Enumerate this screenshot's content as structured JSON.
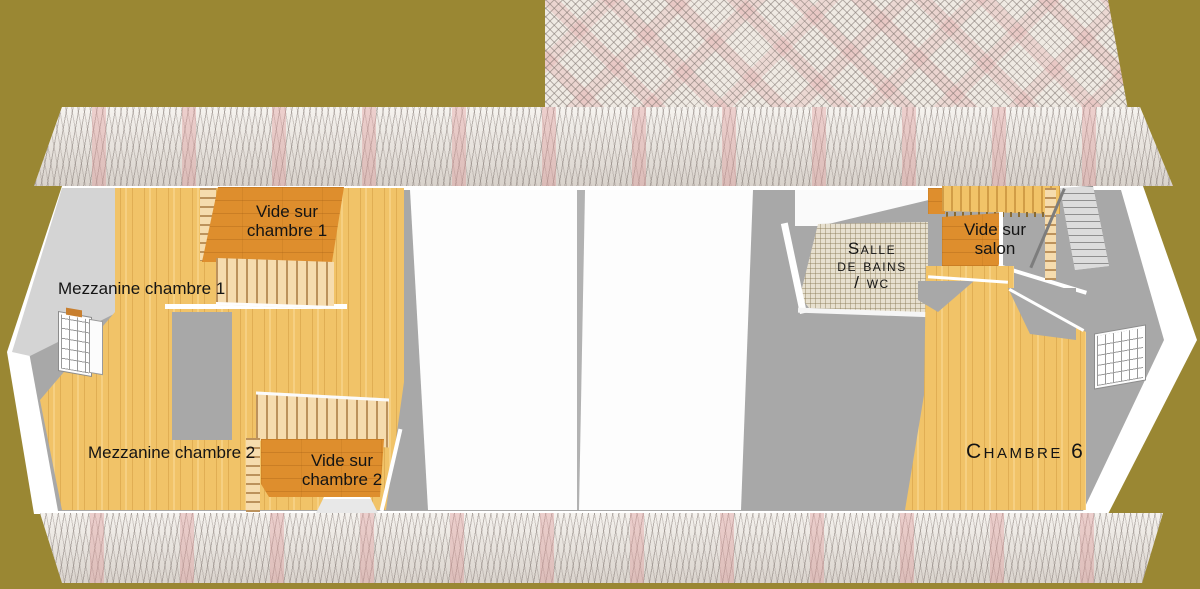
{
  "colors": {
    "background": "#9a8733",
    "roof_base": "#efeae3",
    "roof_pink": "#eec5c5",
    "wood_floor": "#f1c368",
    "wood_void": "#de8e2d",
    "wall_white": "#ffffff",
    "floor_gray": "#a8a8a8",
    "bath_tile": "#e7e0cf"
  },
  "rooms": [
    {
      "id": "vide-sur-chambre-1",
      "label": "Vide sur\nchambre 1"
    },
    {
      "id": "mezzanine-chambre-1",
      "label": "Mezzanine chambre 1"
    },
    {
      "id": "mezzanine-chambre-2",
      "label": "Mezzanine chambre 2"
    },
    {
      "id": "vide-sur-chambre-2",
      "label": "Vide sur\nchambre 2"
    },
    {
      "id": "salle-de-bains-wc",
      "label": "Salle\nde bains\n/ wc"
    },
    {
      "id": "vide-sur-salon",
      "label": "Vide sur\nsalon"
    },
    {
      "id": "chambre-6",
      "label": "Chambre 6"
    }
  ]
}
